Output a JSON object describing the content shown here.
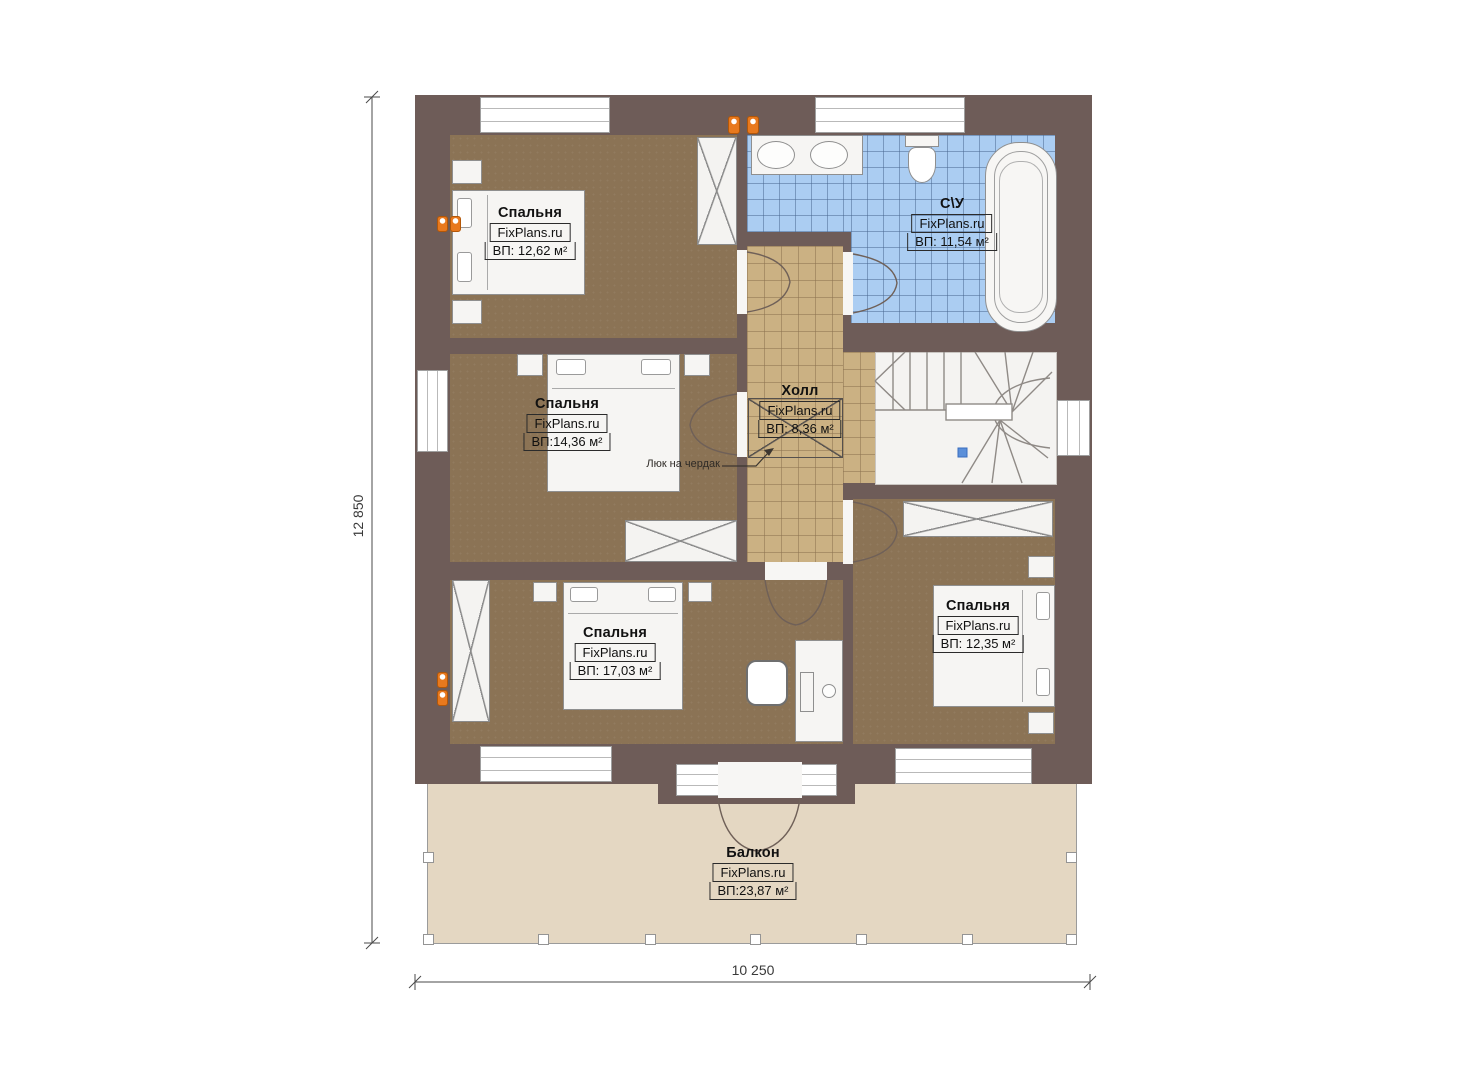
{
  "plan": {
    "brand": "FixPlans.ru",
    "dimension_labels": {
      "height": "12 850",
      "width": "10 250"
    },
    "annotations": {
      "attic_hatch": "Люк на чердак"
    },
    "rooms": [
      {
        "id": "bedroom-top-left",
        "name": "Спальня",
        "area": "ВП: 12,62 м²"
      },
      {
        "id": "bathroom",
        "name": "С\\У",
        "area": "ВП: 11,54 м²"
      },
      {
        "id": "bedroom-middle-left",
        "name": "Спальня",
        "area": "ВП:14,36 м²"
      },
      {
        "id": "hall",
        "name": "Холл",
        "area": "ВП: 8,36 м²"
      },
      {
        "id": "bedroom-bottom-left",
        "name": "Спальня",
        "area": "ВП: 17,03 м²"
      },
      {
        "id": "bedroom-bottom-right",
        "name": "Спальня",
        "area": "ВП: 12,35 м²"
      },
      {
        "id": "balcony",
        "name": "Балкон",
        "area": "ВП:23,87 м²"
      }
    ],
    "colors": {
      "wall": "#6e5c58",
      "bedroom_floor": "#8b7355",
      "hall_floor": "#cbb183",
      "bathroom_floor": "#abcdf2",
      "balcony_floor": "#e4d7c2",
      "marker_orange": "#e8791e",
      "stair_marker_blue": "#5b8fd9"
    }
  }
}
